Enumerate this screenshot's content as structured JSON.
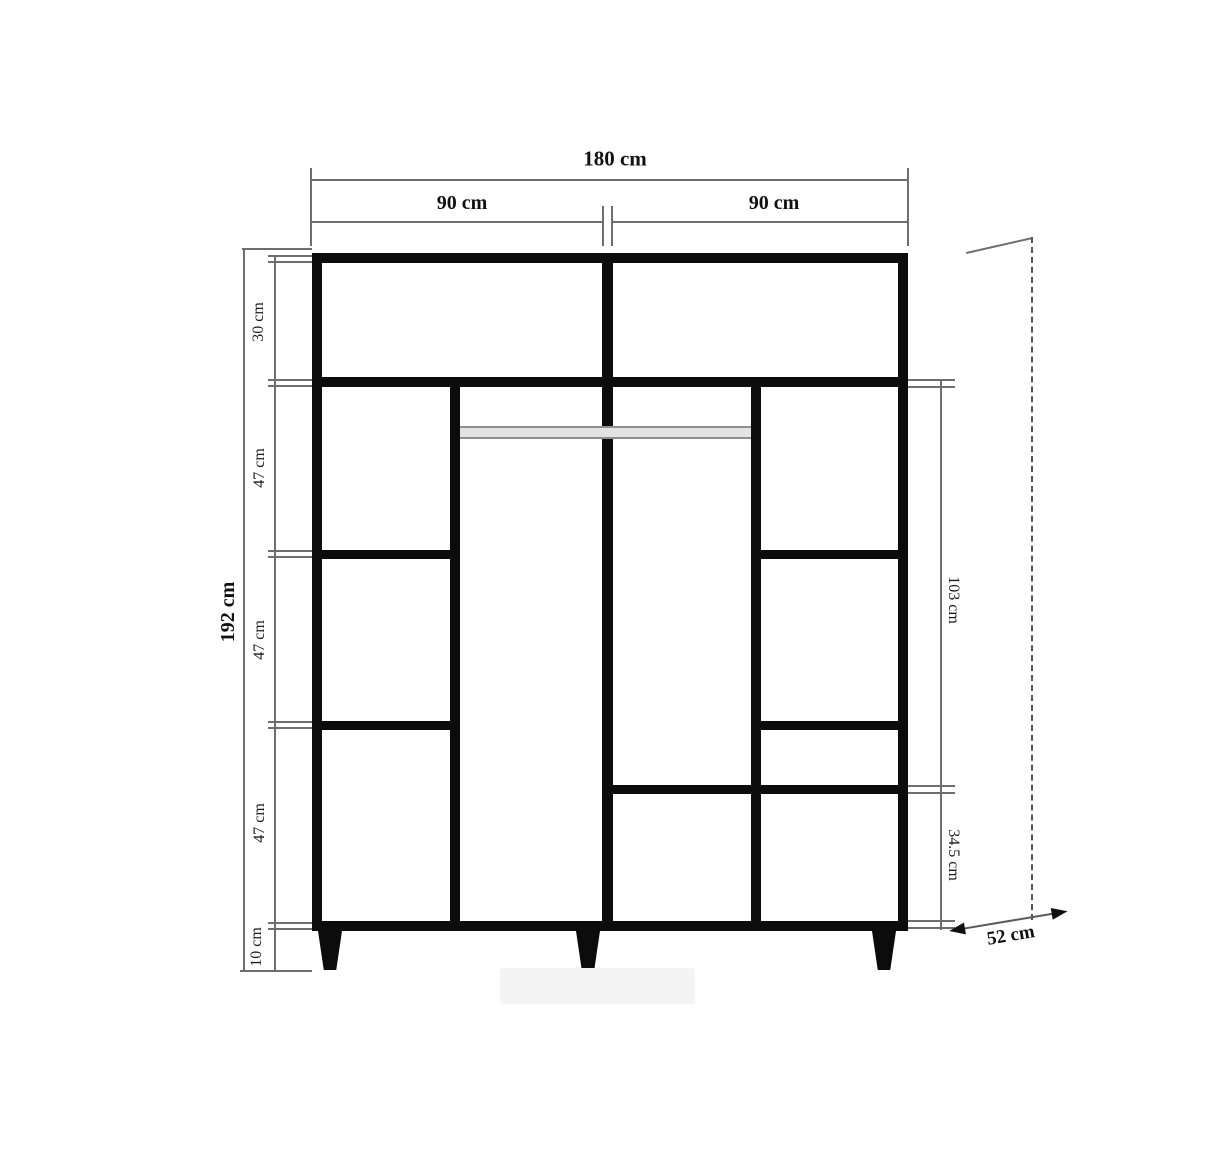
{
  "dimensions": {
    "total_width": "180 cm",
    "left_section_width": "90 cm",
    "right_section_width": "90 cm",
    "total_height": "192 cm",
    "top_compartment_height": "30 cm",
    "upper_shelf_height": "47 cm",
    "middle_shelf_height": "47 cm",
    "lower_shelf_height": "47 cm",
    "leg_height": "10 cm",
    "right_upper_height": "103 cm",
    "right_lower_height": "34.5 cm",
    "depth": "52 cm"
  }
}
